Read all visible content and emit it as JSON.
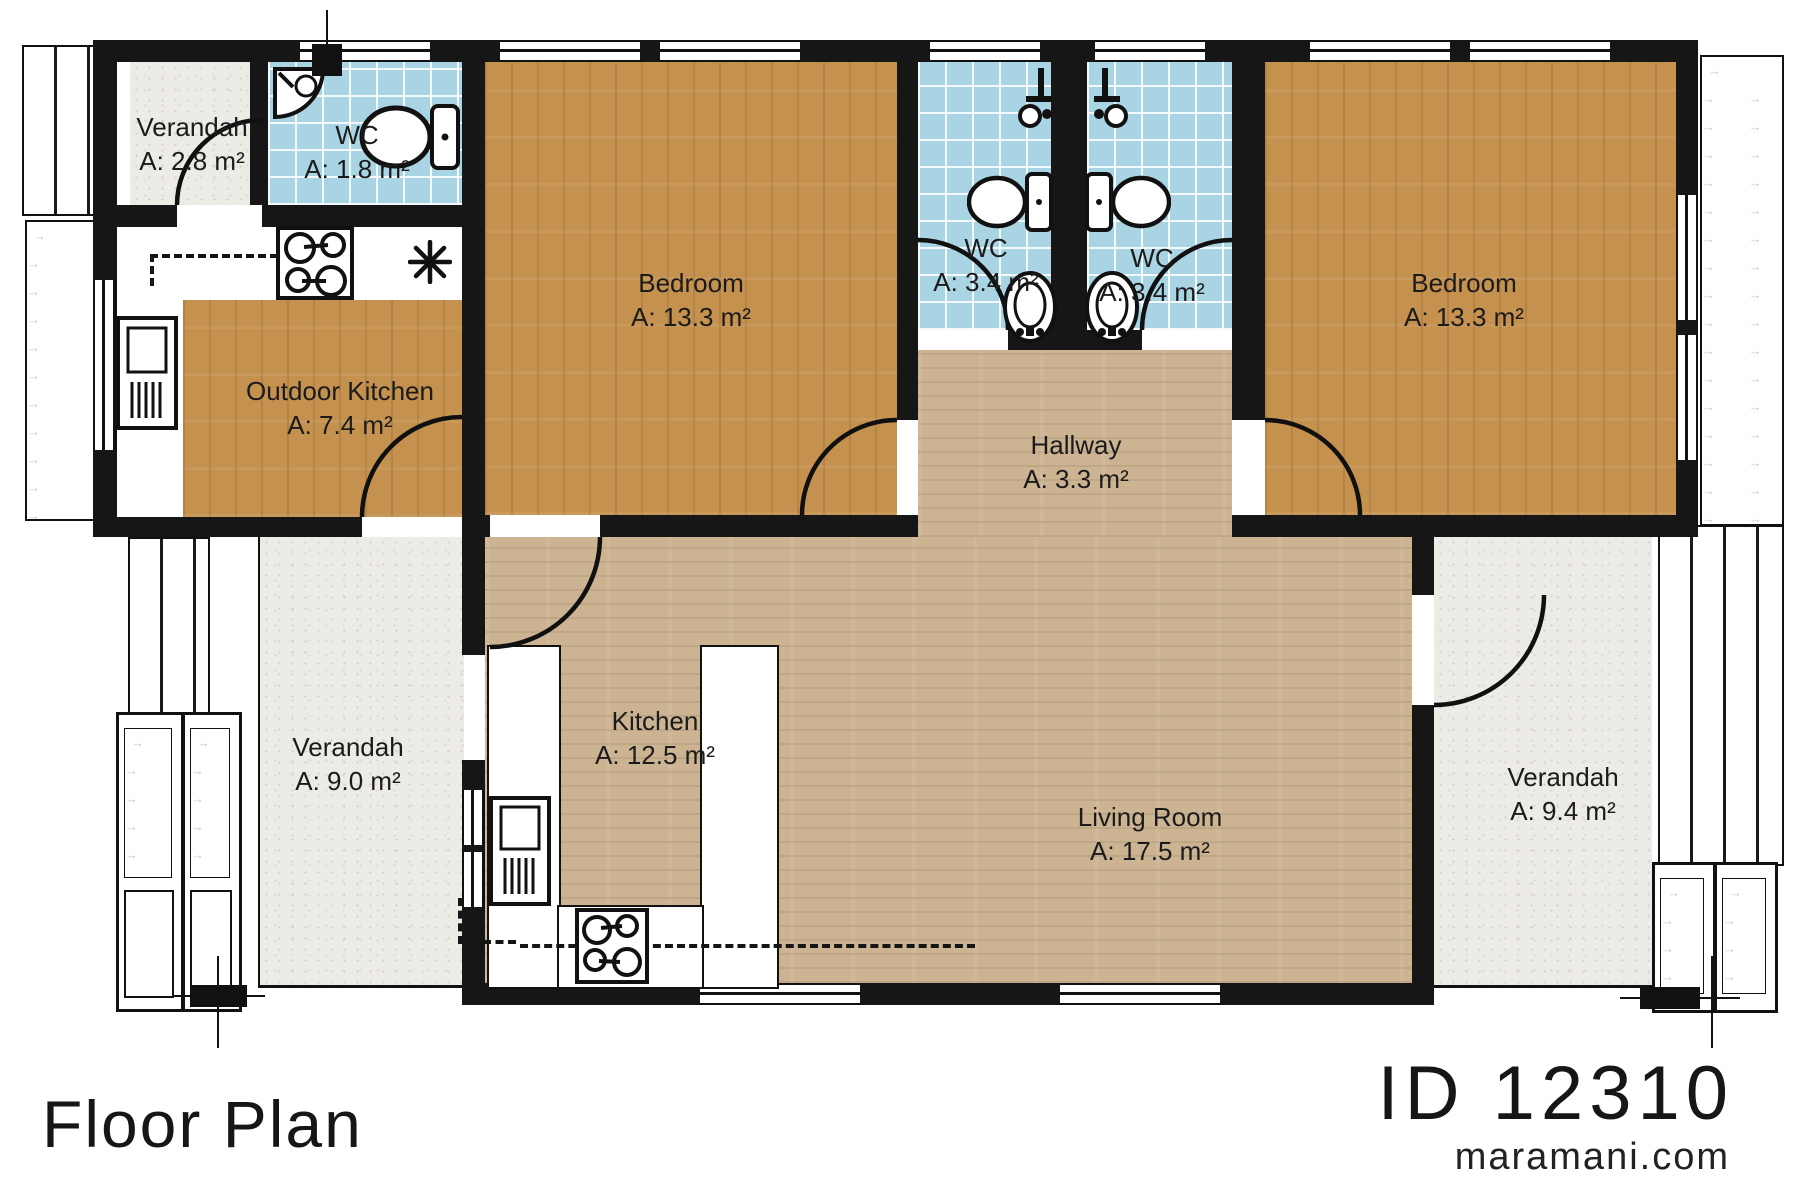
{
  "page": {
    "title": "Floor Plan",
    "plan_id": "ID 12310",
    "website": "maramani.com"
  },
  "rooms": [
    {
      "id": "verandah-top-left",
      "name": "Verandah",
      "area": "A: 2.8 m²"
    },
    {
      "id": "wc-top-left",
      "name": "WC",
      "area": "A: 1.8 m²"
    },
    {
      "id": "outdoor-kitchen",
      "name": "Outdoor Kitchen",
      "area": "A: 7.4 m²"
    },
    {
      "id": "bedroom-left",
      "name": "Bedroom",
      "area": "A: 13.3 m²"
    },
    {
      "id": "wc-center-left",
      "name": "WC",
      "area": "A: 3.4 m²"
    },
    {
      "id": "wc-center-right",
      "name": "WC",
      "area": "A: 3.4 m²"
    },
    {
      "id": "bedroom-right",
      "name": "Bedroom",
      "area": "A: 13.3 m²"
    },
    {
      "id": "hallway",
      "name": "Hallway",
      "area": "A: 3.3 m²"
    },
    {
      "id": "kitchen",
      "name": "Kitchen",
      "area": "A: 12.5 m²"
    },
    {
      "id": "living-room",
      "name": "Living Room",
      "area": "A: 17.5 m²"
    },
    {
      "id": "verandah-bottom-left",
      "name": "Verandah",
      "area": "A: 9.0 m²"
    },
    {
      "id": "verandah-bottom-right",
      "name": "Verandah",
      "area": "A: 9.4 m²"
    }
  ],
  "fixtures": [
    "corner-sink",
    "toilet",
    "shower",
    "wash-basin",
    "stove",
    "fridge",
    "kitchen-sink-asterisk"
  ],
  "colors": {
    "wall": "#161616",
    "wc_tile": "#a9d4e3",
    "bedroom_wood": "#c4914f",
    "living_floor": "#ccb493",
    "verandah_concrete": "#edebe6",
    "deck_arrow": "#ccc9c3"
  },
  "deco": {
    "arrow_char": "→"
  }
}
